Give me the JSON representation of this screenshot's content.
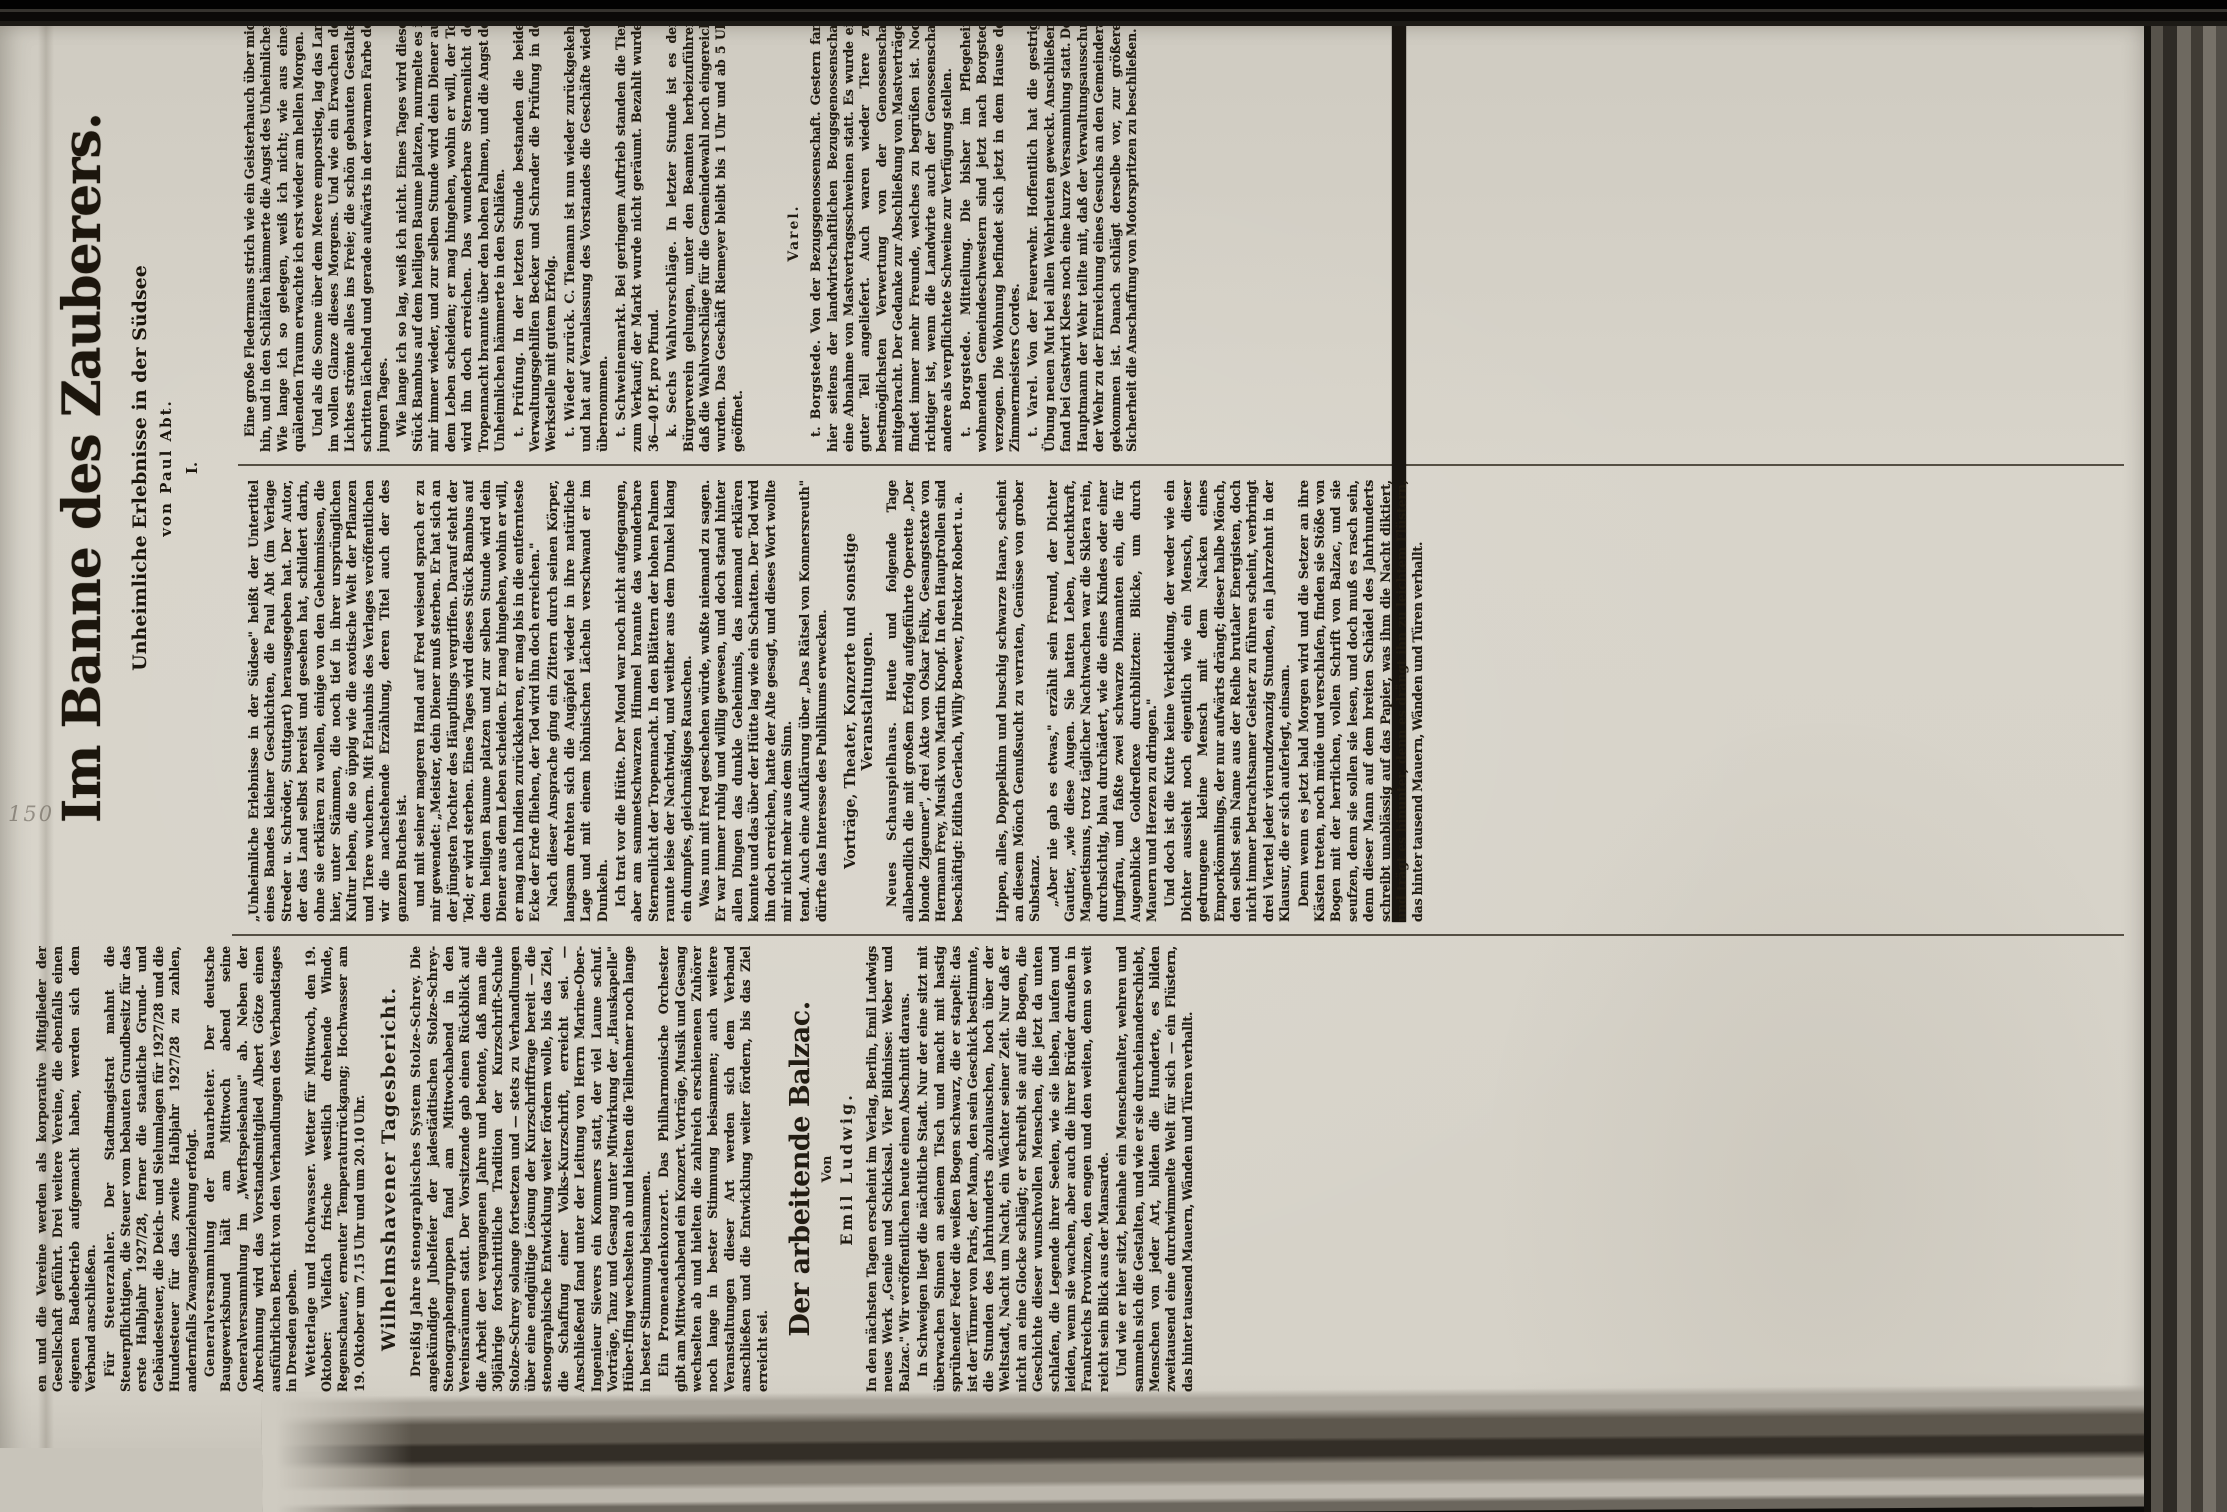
{
  "stamp": "150",
  "feuilleton": {
    "title": "Im Banne des Zauberers.",
    "subtitle": "Unheimliche Erlebnisse in der Südsee",
    "byline": "von Paul Abt.",
    "chapter": "I.",
    "intro": "„Unheimliche Erlebnisse in der Südsee\" heißt der Untertitel eines Bandes kleiner Geschichten, die Paul Abt (im Verlage Streder u. Schröder, Stuttgart) herausgegeben hat. Der Autor, der das Land selbst bereist und gesehen hat, schildert darin, ohne sie erklären zu wollen, einige von den Geheimnissen, die hier, unter Stämmen, die noch tief in ihrer ursprünglichen Kultur leben, die so üppig wie die exotische Welt der Pflanzen und Tiere wuchern. Mit Erlaubnis des Verlages veröffentlichen wir die nachstehende Erzählung, deren Titel auch der des ganzen Buches ist.",
    "p1": "und mit seiner mageren Hand auf Fred weisend sprach er zu mir gewendet: „Meister, dein Diener muß sterben. Er hat sich an der jüngsten Tochter des Häuptlings vergriffen. Darauf steht der Tod; er wird sterben. Eines Tages wird dieses Stück Bambus auf dem heiligen Baume platzen und zur selben Stunde wird dein Diener aus dem Leben scheiden. Er mag hingehen, wohin er will, er mag nach Indien zurückkehren, er mag bis in die entfernteste Ecke der Erde fliehen, der Tod wird ihn doch erreichen.\"",
    "p2": "Nach dieser Ansprache ging ein Zittern durch seinen Körper, langsam drehten sich die Augäpfel wieder in ihre natürliche Lage und mit einem höhnischen Lächeln verschwand er im Dunkeln.",
    "p3": "Ich trat vor die Hütte. Der Mond war noch nicht aufgegangen, aber am sammetschwarzen Himmel brannte das wunderbare Sternenlicht der Tropennacht. In den Blättern der hohen Palmen raunte leise der Nachtwind, und weither aus dem Dunkel klang ein dumpfes, gleichmäßiges Rauschen.",
    "p4": "Eine große Fledermaus strich wie ein Geisterhauch über mich hin, und in den Schläfen hämmerte die Angst des Unheimlichen. Wie lange ich so gelegen, weiß ich nicht; wie aus einem quälenden Traum erwachte ich erst wieder am hellen Morgen.",
    "p5": "Und als die Sonne über dem Meere emporstieg, lag das Land im vollen Glanze dieses Morgens. Und wie ein Erwachen des Lichtes strömte alles ins Freie; die schön gebauten Gestalten schritten lächelnd und gerade aufwärts in der warmen Farbe des jungen Tages.",
    "p6": "Was nun mit Fred geschehen würde, wußte niemand zu sagen. Er war immer ruhig und willig gewesen, und doch stand hinter allen Dingen das dunkle Geheimnis, das niemand erklären konnte und das über der Hütte lag wie ein Schatten. Der Tod wird ihn doch erreichen, hatte der Alte gesagt, und dieses Wort wollte mir nicht mehr aus dem Sinn.",
    "p7": "Wie lange ich so lag, weiß ich nicht. Eines Tages wird dieses Stück Bambus auf dem heiligen Baume platzen, murmelte es in mir immer wieder, und zur selben Stunde wird dein Diener aus dem Leben scheiden; er mag hingehen, wohin er will, der Tod wird ihn doch erreichen. Das wunderbare Sternenlicht der Tropennacht brannte über den hohen Palmen, und die Angst des Unheimlichen hämmerte in den Schläfen."
  },
  "col1": {
    "clip_top": "en und die Vereine werden als korporative Mitglieder der Gesellschaft geführt. Drei weitere Vereine, die ebenfalls einen eigenen Badebetrieb aufgemacht haben, werden sich dem Verband anschließen.",
    "steuer_lead": "Für Steuerzahler.",
    "steuer_text": "Der Stadtmagistrat mahnt die Steuerpflichtigen, die Steuer vom bebauten Grundbesitz für das erste Halbjahr 1927/28, ferner die staatliche Grund- und Gebäudesteuer, die Deich- und Sielumlagen für 1927/28 und die Hundesteuer für das zweite Halbjahr 1927/28 zu zahlen, andernfalls Zwangseinziehung erfolgt.",
    "general_lead": "Generalversammlung der Bauarbeiter.",
    "general_text": "Der deutsche Baugewerksbund hält am Mittwoch abend seine Generalversammlung im „Werftspeisehaus\" ab. Neben der Abrechnung wird das Vorstandsmitglied Albert Götze einen ausführlichen Bericht von den Verhandlungen des Verbandstages in Dresden geben.",
    "wetter_lead": "Wetterlage und Hochwasser.",
    "wetter_text": "Wetter für Mittwoch, den 19. Oktober: Vielfach frische westlich drehende Winde, Regenschauer, erneuter Temperaturrückgang; Hochwasser am 19. Oktober um 7.15 Uhr und um 20.10 Uhr.",
    "tagesbericht_header": "Wilhelmshavener Tagesbericht.",
    "steno_lead": "Dreißig Jahre stenographisches System Stolze-Schrey.",
    "steno_text": "Die angekündigte Jubelfeier der jadestädtischen Stolze-Schrey-Stenographengruppen fand am Mittwochabend in den Vereinsräumen statt. Der Vorsitzende gab einen Rückblick auf die Arbeit der vergangenen Jahre und betonte, daß man die 30jährige fortschrittliche Tradition der Kurzschrift-Schule Stolze-Schrey solange fortsetzen und — stets zu Verhandlungen über eine endgültige Lösung der Kurzschriftfrage bereit — die stenographische Entwicklung weiter fördern wolle, bis das Ziel, die Schaffung einer Volks-Kurzschrift, erreicht sei. — Anschließend fand unter der Leitung von Herrn Marine-Ober-Ingenieur Sievers ein Kommers statt, der viel Laune schuf. Vorträge, Tanz und Gesang unter Mitwirkung der „Hauskapelle\" Hüber-Ifing wechselten ab und hielten die Teilnehmer noch lange in bester Stimmung beisammen.",
    "promenade_lead": "Ein Promenadenkonzert.",
    "promenade_text": "Das Philharmonische Orchester gibt am Mittwochabend ein Konzert. Vorträge, Musik und Gesang wechselten ab und hielten die zahlreich erschienenen Zuhörer noch lange in bester Stimmung beisammen; auch weitere Veranstaltungen dieser Art werden sich dem Verband anschließen und die Entwicklung weiter fördern, bis das Ziel erreicht sei.",
    "balzac_title": "Der arbeitende Balzac.",
    "balzac_von": "Von",
    "balzac_author": "Emil Ludwig.",
    "balzac_intro": "In den nächsten Tagen erscheint im Verlag, Berlin, Emil Ludwigs neues Werk „Genie und Schicksal. Vier Bildnisse: Weber und Balzac.\" Wir veröffentlichen heute einen Abschnitt daraus.",
    "balzac_p1": "In Schweigen liegt die nächtliche Stadt. Nur der eine sitzt mit überwachen Sinnen an seinem Tisch und macht mit hastig sprühender Feder die weißen Bogen schwarz, die er stapelt: das ist der Türmer von Paris, der Mann, den sein Geschick bestimmte, die Stunden des Jahrhunderts abzulauschen, hoch über der Weltstadt, Nacht um Nacht, ein Wächter seiner Zeit. Nur daß er nicht an eine Glocke schlägt; er schreibt sie auf die Bogen, die Geschichte dieser wunschvollen Menschen, die jetzt da unten schlafen, die Legende ihrer Seelen, wie sie lieben, laufen und leiden, wenn sie wachen, aber auch die ihrer Brüder draußen in Frankreichs Provinzen, den engen und den weiten, denn so weit reicht sein Blick aus der Mansarde.",
    "balzac_p2": "Und wie er hier sitzt, beinahe ein Menschenalter, wehren und sammeln sich die Gestalten, und wie er sie durcheinanderschiebt, Menschen von jeder Art, bilden die Hunderte, es bilden zweitausend eine durchwimmelte Welt für sich — ein Flüstern, das hinter tausend Mauern, Wänden und Türen verhallt."
  },
  "col2": {
    "konners_end": "tend. Auch eine Aufklärung über „Das Rätsel von Konnersreuth\" dürfte das Interesse des Publikums erwecken.",
    "events_header": "Vorträge, Theater, Konzerte und sonstige Veranstaltungen.",
    "schau_lead": "Neues Schauspielhaus.",
    "schau_text": "Heute und folgende Tage allabendlich die mit großem Erfolg aufgeführte Operette „Der blonde Zigeuner\", drei Akte von Oskar Felix, Gesangstexte von Hermann Frey, Musik von Martin Knopf. In den Hauptrollen sind beschäftigt: Editha Gerlach, Willy Boewer, Direktor Robert u. a.",
    "balzac_p1": "Lippen, alles, Doppelkinn und buschig schwarze Haare, scheint an diesem Mönch Genußsucht zu verraten, Genüsse von grober Substanz.",
    "balzac_p2": "„Aber nie gab es etwas,\" erzählt sein Freund, der Dichter Gautier, „wie diese Augen. Sie hatten Leben, Leuchtkraft, Magnetismus, trotz täglicher Nachtwachen war die Sklera rein, durchsichtig, blau durchädert, wie die eines Kindes oder einer Jungfrau, und faßte zwei schwarze Diamanten ein, die für Augenblicke Goldreflexe durchblitzten: Blicke, um durch Mauern und Herzen zu dringen.\"",
    "balzac_p3": "Und doch ist die Kutte keine Verkleidung, der weder wie ein Dichter aussieht noch eigentlich wie ein Mensch, dieser gedrungene kleine Mensch mit dem Nacken eines Emporkömmlings, der nur aufwärts drängt; dieser halbe Mönch, den selbst sein Name aus der Reihe brutaler Energisten, doch nicht immer betrachtsamer Geister zu führen scheint, verbringt drei Viertel jeder vierundzwanzig Stunden, ein Jahrzehnt in der Klausur, die er sich auferlegt, einsam.",
    "balzac_p4": "Denn wenn es jetzt bald Morgen wird und die Setzer an ihre Kästen treten, noch müde und verschlafen, finden sie Stöße von Bogen mit der herrlichen, vollen Schrift von Balzac, und sie seufzen, denn sie sollen sie lesen, und doch muß es rasch sein, denn dieser Mann auf dem breiten Schädel des Jahrhunderts schreibt unablässig auf das Papier, was ihm die Nacht diktiert, und trägt es hinunter, denn es drängt ihn zu leichtem Flüstern, das hinter tausend Mauern, Wänden und Türen verhallt."
  },
  "col3": {
    "pruefung_lead": "t. Prüfung.",
    "pruefung_text": "In der letzten Stunde bestanden die beiden Verwaltungsgehilfen Becker und Schrader die Prüfung in der Werkstelle mit gutem Erfolg.",
    "zurueck_lead": "t. Wieder zurück.",
    "zurueck_text": "C. Tiemann ist nun wieder zurückgekehrt und hat auf Veranlassung des Vorstandes die Geschäfte wieder übernommen.",
    "schweine_lead": "t. Schweinemarkt.",
    "schweine_text": "Bei geringem Auftrieb standen die Tiere zum Verkauf; der Markt wurde nicht geräumt. Bezahlt wurden 36—40 Pf. pro Pfund.",
    "wahl_lead": "k. Sechs Wahlvorschläge.",
    "wahl_text": "In letzter Stunde ist es dem Bürgerverein gelungen, unter den Beamten herbeizuführen, daß die Wahlvorschläge für die Gemeindewahl noch eingereicht wurden. Das Geschäft Riemeyer bleibt bis 1 Uhr und ab 5 Uhr geöffnet.",
    "varel_header": "Varel.",
    "borg1_lead": "t. Borgstede.",
    "borg1_text": "Von der Bezugsgenossenschaft. Gestern fand hier seitens der landwirtschaftlichen Bezugsgenossenschaft eine Abnahme von Mastvertragsschweinen statt. Es wurde ein guter Teil angeliefert. Auch waren wieder Tiere zur bestmöglichsten Verwertung von der Genossenschaft mitgebracht. Der Gedanke zur Abschließung von Mastverträgen findet immer mehr Freunde, welches zu begrüßen ist. Noch richtiger ist, wenn die Landwirte auch der Genossenschaft andere als verpflichtete Schweine zur Verfügung stellen.",
    "borg2_lead": "t. Borgstede.",
    "borg2_text": "Mitteilung. Die bisher im Pflegeheim wohnenden Gemeindeschwestern sind jetzt nach Borgstede verzogen. Die Wohnung befindet sich jetzt in dem Hause des Zimmermeisters Cordes.",
    "feuer_lead": "t. Varel.",
    "feuer_text": "Von der Feuerwehr. Hoffentlich hat die gestrige Übung neuen Mut bei allen Wehrleuten geweckt. Anschließend fand bei Gastwirt Klees noch eine kurze Versammlung statt. Der Hauptmann der Wehr teilte mit, daß der Verwaltungsausschuß der Wehr zu der Einreichung eines Gesuchs an den Gemeinderat gekommen ist. Danach schlägt derselbe vor, zur größeren Sicherheit die Anschaffung von Motorspritzen zu beschließen."
  }
}
